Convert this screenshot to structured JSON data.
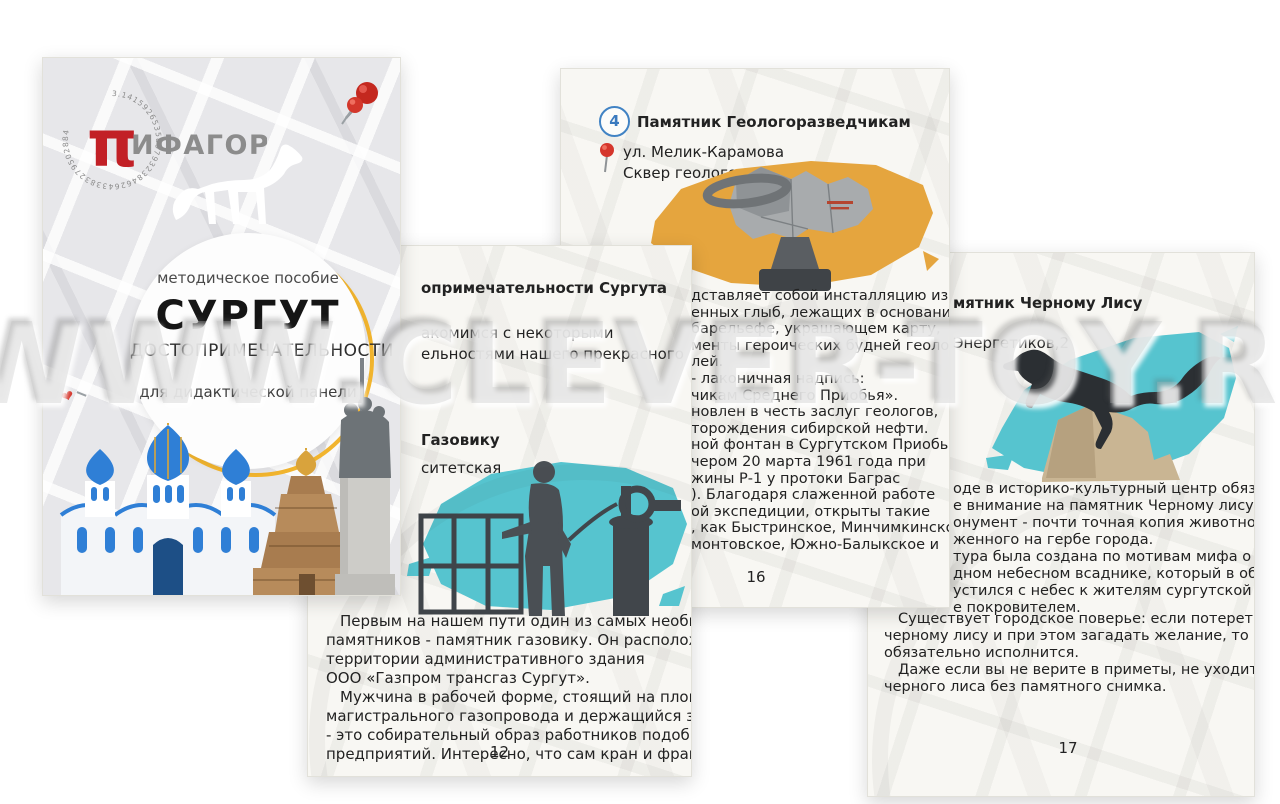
{
  "watermark": {
    "text": "WWW.CLEVER-TOY.RU"
  },
  "colors": {
    "teal_brush": "#56c4cf",
    "ochre_brush": "#e5a53e",
    "logo_red": "#c22026",
    "pin_red": "#d5362c",
    "badge_blue": "#4183c4",
    "ring_yellow": "#f1b42e",
    "dome_blue": "#2f7fd6",
    "ink": "#222222"
  },
  "cover": {
    "brand_pi": "π",
    "brand_name": "ИФАГОР",
    "brand_ring_digits": "3.141592653589793238462643383279502884",
    "series": "методическое пособие",
    "title": "СУРГУТ",
    "subtitle": "ДОСТОПРИМЕЧАТЕЛЬНОСТИ",
    "note": "для дидактической панели"
  },
  "page12": {
    "heading_fragment": "опримечательности Сургута",
    "intro_fragments": [
      "акомимся с некоторыми",
      "ельностями нашего прекрасного"
    ],
    "title_fragment": "Газовику",
    "address_fragment": "ситетская",
    "body": [
      "Первым на нашем пути один из самых необычных",
      "памятников - памятник газовику. Он расположен на",
      "территории административного здания",
      "ООО «Газпром трансгаз Сургут».",
      "Мужчина в рабочей форме, стоящий на площадке",
      "магистрального газопровода и держащийся за кран,",
      "- это собирательный образ работников подобных",
      "предприятий. Интересно, что сам кран и фрагмент"
    ],
    "page_number": "12"
  },
  "page16": {
    "badge": "4",
    "title": "Памятник Геологоразведчикам",
    "address_line1": "ул. Мелик-Карамова",
    "address_line2": "Сквер геологов Сургута",
    "body": [
      "дставляет собой инсталляцию из",
      "енных глыб, лежащих в основании",
      "барельефе, украшающем карту,",
      "менты героических будней геологов-",
      "лей.",
      "- лаконичная надпись:",
      "чикам Среднего Приобья».",
      "новлен в честь заслуг геологов,",
      "торождения сибирской нефти.",
      "ной фонтан в Сургутском Приобье",
      "чером 20 марта 1961 года при",
      "жины Р-1 у протоки Баграс",
      "). Благодаря слаженной работе",
      "ой экспедиции, открыты такие",
      ", как Быстринское, Минчимкинское,",
      "монтовское, Южно-Балыкское и"
    ],
    "page_number": "16"
  },
  "page17": {
    "title_fragment": "мятник Черному Лису",
    "address_fragment": "Энергетиков,2",
    "body_clipped": [
      "оде в историко-культурный центр обязательно",
      "е внимание на памятник Черному лису.",
      "онумент - почти точная копия животного,",
      "женного на гербе города.",
      "тура была создана по мотивам мифа о",
      "дном небесном всаднике, который в образе",
      "устился с небес к жителям сургутской земли",
      "е покровителем."
    ],
    "body_full": [
      "Существует городское поверье: если потереть лапу",
      "черному лису и при этом загадать желание, то оно",
      "обязательно исполнится.",
      "Даже если вы не верите в приметы, не уходите от",
      "черного лиса без памятного снимка."
    ],
    "page_number": "17"
  }
}
